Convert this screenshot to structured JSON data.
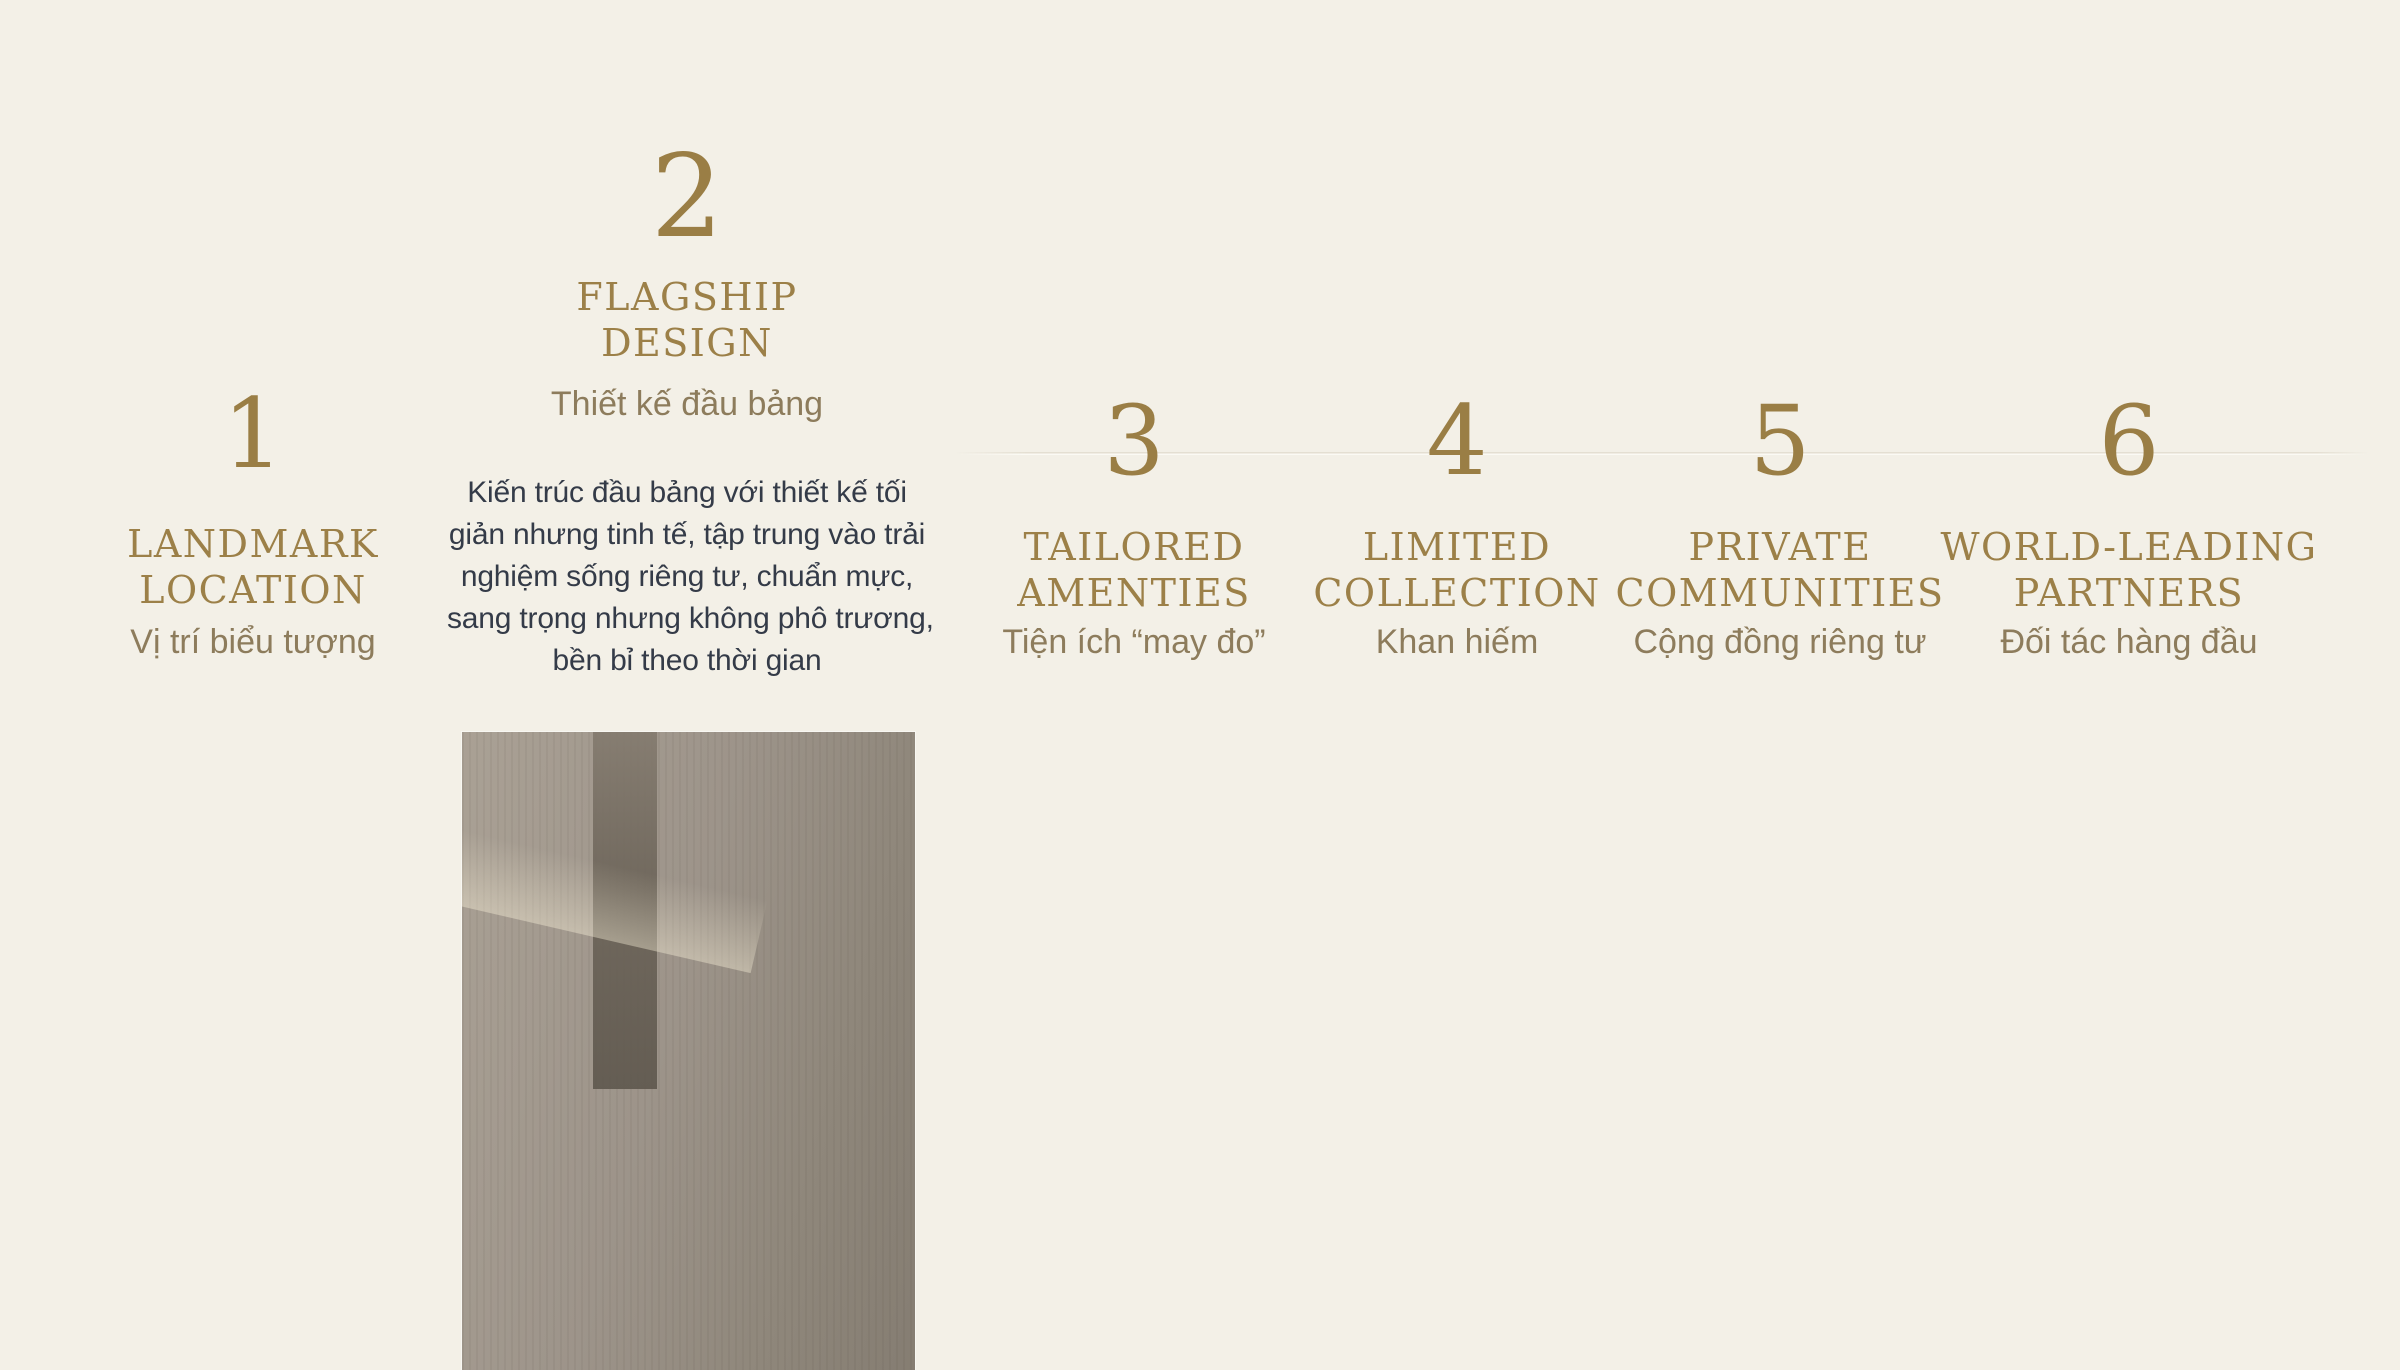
{
  "slide": {
    "background": "#f3f0e7",
    "accent_gold": "#9a7e45",
    "muted_gold": "#8d7c5c",
    "body_text_color": "#343b48"
  },
  "sections": [
    {
      "number": "1",
      "title_lines": [
        "LANDMARK",
        "LOCATION"
      ],
      "subtitle": "Vị trí biểu tượng"
    },
    {
      "number": "2",
      "title_lines": [
        "FLAGSHIP",
        "DESIGN"
      ],
      "subtitle": "Thiết kế đầu bảng",
      "description_lines": [
        "Kiến trúc đầu bảng với thiết kế tối",
        "giản nhưng tinh tế, tập trung vào trải",
        "nghiệm sống riêng tư, chuẩn mực,",
        "sang trọng nhưng không phô trương,",
        "bền bỉ theo thời gian"
      ],
      "photo_alt": "Luxury minimalist lobby lounge: cream curved sofas, brown velvet ottomans, round dark coffee table with green plant, white drum floor lamp, lit alcove with ceramic wall plates, polished dark stone floor"
    },
    {
      "number": "3",
      "title_lines": [
        "TAILORED",
        "AMENTIES"
      ],
      "subtitle": "Tiện ích “may đo”"
    },
    {
      "number": "4",
      "title_lines": [
        "LIMITED",
        "COLLECTION"
      ],
      "subtitle": "Khan hiếm"
    },
    {
      "number": "5",
      "title_lines": [
        "PRIVATE",
        "COMMUNITIES"
      ],
      "subtitle": "Cộng đồng riêng tư"
    },
    {
      "number": "6",
      "title_lines": [
        "WORLD-LEADING",
        "PARTNERS"
      ],
      "subtitle": "Đối tác hàng đầu"
    }
  ]
}
